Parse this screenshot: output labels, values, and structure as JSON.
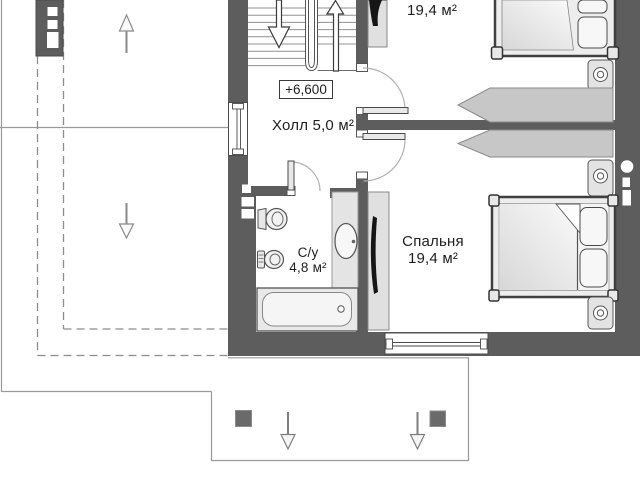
{
  "page": {
    "kind": "architectural floor plan, attic level"
  },
  "labels": {
    "bedroom_top_area": "19,4 м²",
    "elevation_mark": "+6,600",
    "hall": "Холл 5,0 м²",
    "bathroom_name": "С/у",
    "bathroom_area": "4,8 м²",
    "bedroom_name": "Спальня",
    "bedroom_area": "19,4 м²"
  },
  "colors": {
    "wall": "#5d5d5d",
    "background": "#ffffff",
    "furniture_fill": "#ececec",
    "wardrobe_fill": "#c7c7c7",
    "outline": "#4a4a4a",
    "thin_line": "#9a9a9a",
    "dashed_line": "#8c8c8c",
    "text": "#1e1e1e"
  }
}
